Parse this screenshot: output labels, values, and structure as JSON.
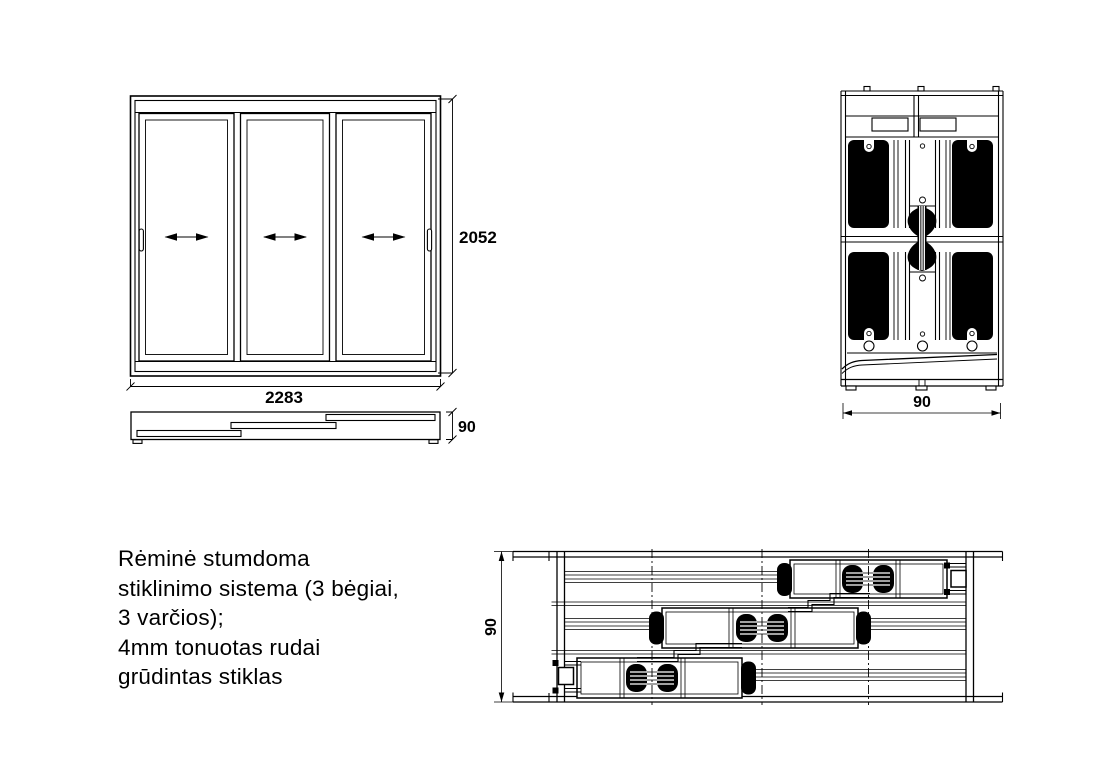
{
  "colors": {
    "ink": "#000000",
    "paper": "#ffffff"
  },
  "drawing": {
    "front_elevation": {
      "width_dim": "2283",
      "height_dim": "2052"
    },
    "plan_view": {
      "thickness_dim": "90"
    },
    "vertical_section": {
      "width_dim": "90"
    },
    "horizontal_section": {
      "thickness_dim": "90"
    }
  },
  "description": {
    "lines": [
      "Rėminė stumdoma",
      "stiklinimo sistema (3 bėgiai,",
      "3 varčios);",
      "4mm tonuotas rudai",
      "grūdintas stiklas"
    ]
  }
}
